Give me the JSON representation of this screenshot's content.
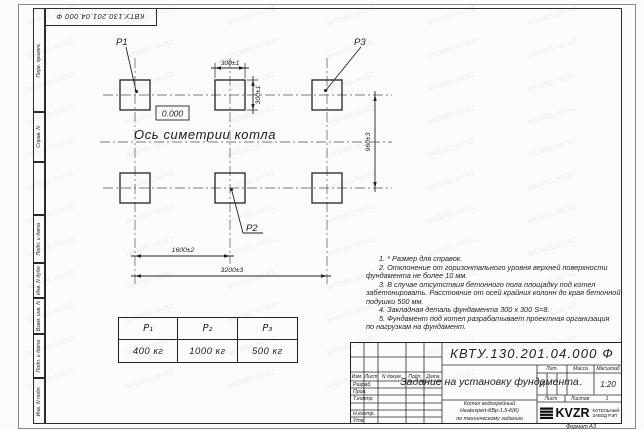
{
  "watermark": {
    "text": "NASHEL-NV.KZ",
    "count": 72
  },
  "stamp_top": "КВТУ.130.201.04.000 Ф",
  "frame_labels": {
    "perv": "Перв. примен.",
    "sprav": "Справ. N",
    "podp1": "Подп. и дата",
    "inv_dubl": "Инв. N дубл.",
    "vzam": "Взам. инв. N",
    "podp2": "Подп. и дата",
    "inv_podl": "Инв. N подл."
  },
  "drawing": {
    "p1": "P1",
    "p2": "P2",
    "p3": "P3",
    "dim_300_h": "300±1",
    "dim_300_v": "300±1",
    "dim_960": "960±3",
    "dim_1600": "1600±2",
    "dim_3200": "3200±3",
    "zero_level": "0.000",
    "axis_label": "Ось симетрии котла"
  },
  "notes": {
    "lines": [
      "1. * Размер для справок.",
      "2. Отклонение от горизонтального уровня верхней поверхности",
      "фундамента не более 10 мм.",
      "3. В случае отсутствия бетонного пола площадку под котел",
      "забетонировать. Расстояние от осей крайних колонн до края бетонной",
      "подушки 500 мм.",
      "4. Закладная деталь фундамента 300 x 300 S=8.",
      "5. Фундамент под котел разрабатывает проектная организация",
      "по нагрузкам на фундамент."
    ]
  },
  "load_table": {
    "headers": [
      "P₁",
      "P₂",
      "P₃"
    ],
    "values": [
      "400 кг",
      "1000 кг",
      "500 кг"
    ]
  },
  "title_block": {
    "doc_number": "КВТУ.130.201.04.000 Ф",
    "title": "Задание на установку фундамента",
    "subtitle_lines": [
      "Котел водогрейный",
      "Heatexpert-КВр-1,5-К(К)",
      "по техническому заданию"
    ],
    "col_izm": "Изм.",
    "col_list": "Лист",
    "col_ndoc": "N докум.",
    "col_podp": "Подп.",
    "col_data": "Дата",
    "row_razrab": "Разраб.",
    "row_prov": "Пров.",
    "row_tkontr": "Т.контр.",
    "row_nkontr": "Н.контр.",
    "row_utv": "Утв.",
    "lit_label": "Лит.",
    "mass_label": "Масса",
    "scale_label": "Масштаб",
    "lit_value": "И",
    "mass_value": "-",
    "scale_value": "1:20",
    "sheet_label": "Лист",
    "sheets_label": "Листов",
    "sheets_value": "1",
    "logo_text": "KVZR",
    "logo_caption_lines": [
      "КОТЕЛЬНЫЙ",
      "ЗАВОД РЭП"
    ],
    "format_label": "Формат А3"
  }
}
